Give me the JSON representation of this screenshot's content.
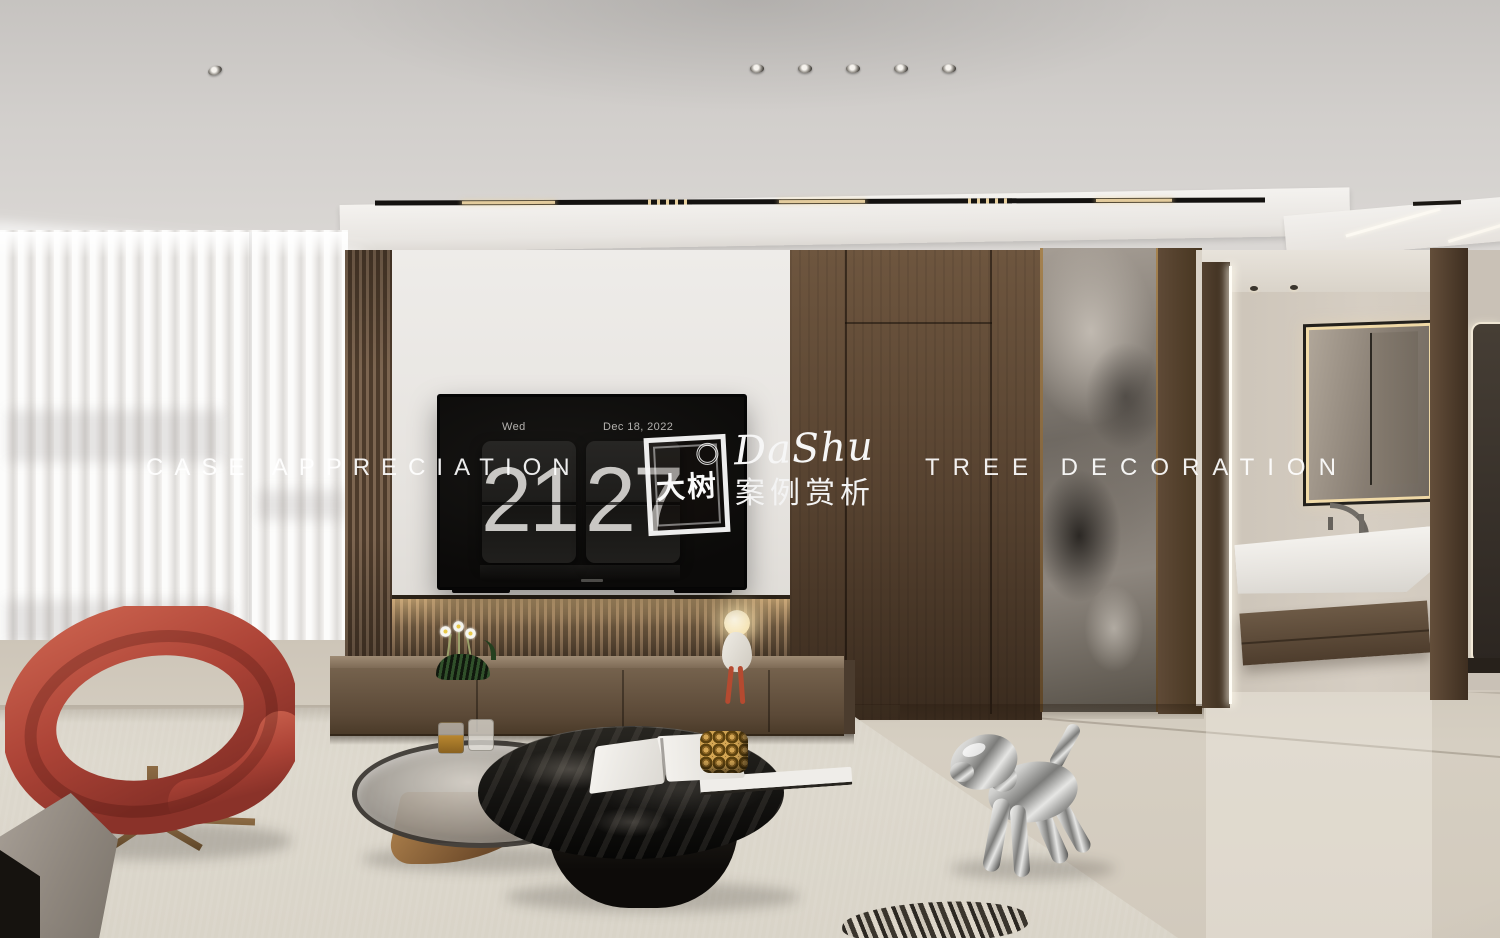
{
  "watermark": {
    "left_text": "CASE APPRECIATION",
    "right_text": "TREE DECORATION",
    "brand_script": "DaShu",
    "brand_subtitle": "案例赏析",
    "seal_text": "大树"
  },
  "tv_clock": {
    "day": "Wed",
    "date": "Dec 18, 2022",
    "hours": "21",
    "minutes": "27"
  },
  "palette": {
    "ceiling_gray": "#d2cfcc",
    "wall_white": "#e9e7e4",
    "wood_brown": "#5d4937",
    "marble_gray": "#8f8881",
    "floor_beige": "#d2cbbf",
    "rug_beige": "#dbd6cb",
    "chair_red": "#ae4538",
    "bronze_trim": "#8a6a48",
    "clock_digit_gray": "#c9c7c4",
    "led_warm": "#f6deaa",
    "watermark_white": "#ffffff"
  },
  "scene_items": [
    "sheer-curtains",
    "wood-slat-panel",
    "tv-flip-clock",
    "tv-cabinet",
    "concealed-door",
    "marble-feature-strip",
    "bathroom-vanity",
    "backlit-mirror",
    "red-lounge-chair",
    "glass-coffee-table",
    "black-stone-coffee-table",
    "balloon-dog-sculpture",
    "gray-ottoman",
    "zebra-cushion",
    "cat-vase",
    "figurine-lamp"
  ]
}
